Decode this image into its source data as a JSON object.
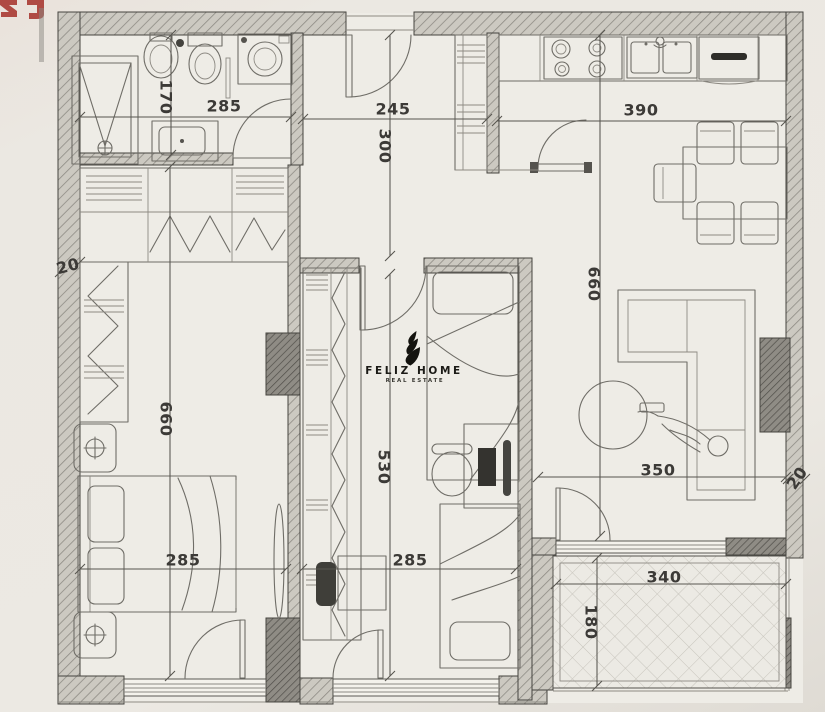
{
  "brand": {
    "title": "FELIZ HOME",
    "subtitle": "REAL ESTATE"
  },
  "dimensions_cm": {
    "bathroom_depth": "170",
    "bathroom_width": "285",
    "hall_width": "245",
    "hall_depth": "300",
    "kitchen_living_width": "390",
    "kitchen_living_depth": "660",
    "bedroom_depth": "660",
    "bedroom_width": "285",
    "kids_room_depth": "530",
    "kids_room_width": "285",
    "living_width": "350",
    "balcony_width": "340",
    "balcony_depth": "180",
    "wall_thickness_left": "20",
    "wall_thickness_right": "20"
  },
  "colors": {
    "paper": "#ebe8e2",
    "wall_hatch": "#ccc9c1",
    "ink": "#4b4946",
    "brand_red": "#a83832",
    "logo_black": "#14130f"
  }
}
